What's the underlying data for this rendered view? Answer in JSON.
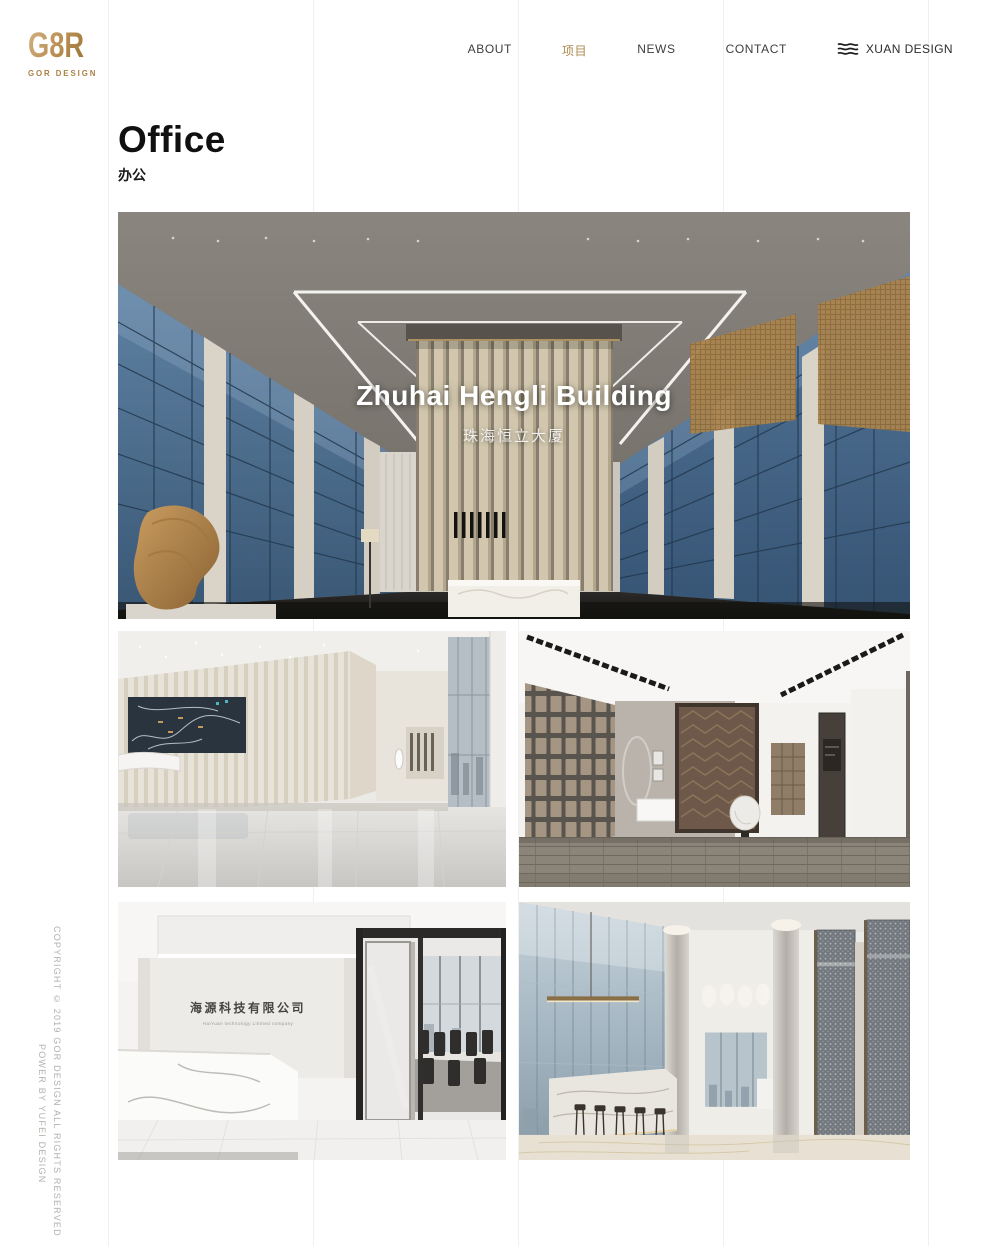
{
  "brand": {
    "logo": "G8R",
    "tagline": "GOR DESIGN",
    "gold": "#ab8145"
  },
  "nav": {
    "items": [
      {
        "label": "ABOUT",
        "active": false
      },
      {
        "label": "项目",
        "active": true
      },
      {
        "label": "NEWS",
        "active": false
      },
      {
        "label": "CONTACT",
        "active": false
      }
    ],
    "partner_label": "XUAN DESIGN"
  },
  "page": {
    "title": "Office",
    "subtitle": "办公"
  },
  "hero": {
    "title": "Zhuhai Hengli Building",
    "subtitle": "珠海恒立大厦"
  },
  "gallery": {
    "reception_sign": "海源科技有限公司",
    "reception_sign_sub": "HaiYuan technology Limited company"
  },
  "footer": {
    "copyright": "COPYRIGHT © 2019 GOR DESIGN ALL RIGHTS RESERVED",
    "credit": "POWER BY YUFEI DESIGN"
  },
  "colors": {
    "accent_gold": "#ad8b4f",
    "grid_line": "#f1f0ee"
  }
}
